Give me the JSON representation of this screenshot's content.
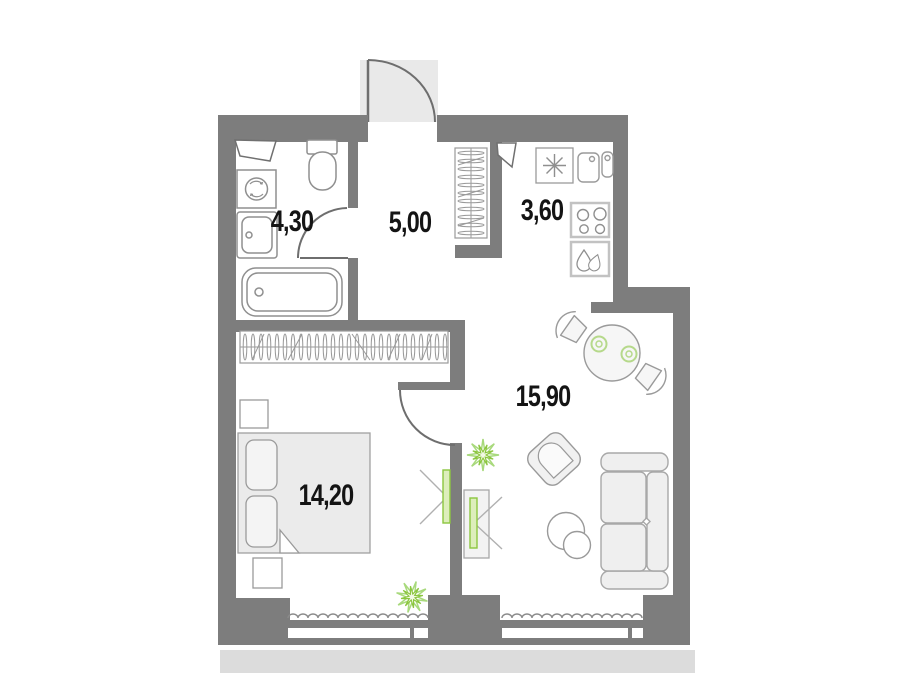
{
  "plan": {
    "type": "apartment-floor-plan",
    "rooms": [
      {
        "name": "bathroom",
        "area": "4,30"
      },
      {
        "name": "hallway",
        "area": "5,00"
      },
      {
        "name": "kitchen",
        "area": "3,60"
      },
      {
        "name": "living-room",
        "area": "15,90"
      },
      {
        "name": "bedroom",
        "area": "14,20"
      }
    ],
    "colors": {
      "wall": "#7d7d7d",
      "entrance_pad": "#e9e9e9",
      "furniture_line": "#9a9a9a",
      "furniture_fill": "#efefef",
      "accent_green": "#8cc63f",
      "accent_green_light": "#cde6a0",
      "lower_band": "#dcdcdc",
      "label_text": "#141414"
    },
    "furniture": {
      "bathroom": [
        "vent-duct",
        "washing-machine",
        "sink",
        "toilet",
        "bathtub"
      ],
      "hallway": [
        "entrance-door",
        "wardrobe",
        "vent-duct"
      ],
      "kitchen": [
        "fridge",
        "sink",
        "stove",
        "dishwasher"
      ],
      "living_room": [
        "dining-table",
        "chair",
        "chair",
        "plate",
        "plate",
        "armchair",
        "coffee-table",
        "coffee-table",
        "sofa",
        "tv-stand",
        "tv",
        "plant",
        "radiator",
        "window"
      ],
      "bedroom": [
        "wardrobe",
        "bed",
        "nightstand",
        "nightstand",
        "tv",
        "plant",
        "radiator",
        "window"
      ]
    }
  }
}
